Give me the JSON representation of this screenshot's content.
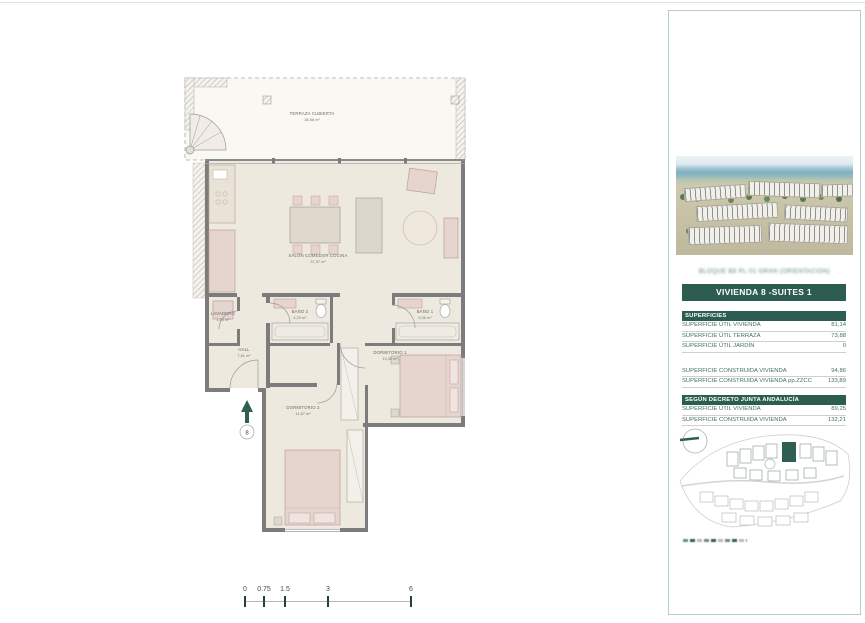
{
  "floorplan": {
    "rooms": [
      {
        "name": "TERRAZA CUBIERTA",
        "area": "38,58 m²"
      },
      {
        "name": "SALÓN COMEDOR COCINA",
        "area": "37,97 m²"
      },
      {
        "name": "LAVADERO",
        "area": "1,54 m²"
      },
      {
        "name": "HALL",
        "area": "7,81 m²"
      },
      {
        "name": "BAÑO 2",
        "area": "4,29 m²"
      },
      {
        "name": "BAÑO 1",
        "area": "5,06 m²"
      },
      {
        "name": "DORMITORIO 1",
        "area": "13,30 m²"
      },
      {
        "name": "DORMITORIO 2",
        "area": "11,87 m²"
      }
    ],
    "entrance_marker": "8",
    "scale_bar": {
      "ticks": [
        "0",
        "0.75",
        "1.5",
        "3",
        "6"
      ]
    }
  },
  "sidebar": {
    "project_line": "BLOQUE B8 PL-01 GRAN (ORIENTACIÓN)",
    "unit_title": "VIVIENDA 8 -SUITES 1",
    "surfaces": {
      "header": "SUPERFICIES",
      "rows": [
        {
          "label": "SUPERFICIE ÚTIL VIVIENDA",
          "value": "81,14"
        },
        {
          "label": "SUPERFICIE ÚTIL TERRAZA",
          "value": "73,88"
        },
        {
          "label": "SUPERFICIE ÚTIL JARDÍN",
          "value": "0"
        }
      ],
      "rows2": [
        {
          "label": "SUPERFICIE CONSTRUIDA VIVIENDA",
          "value": "94,86"
        },
        {
          "label": "SUPERFICIE CONSTRUIDA VIVIENDA pp.ZZCC",
          "value": "133,89"
        }
      ],
      "decree_header": "SEGÚN DECRETO JUNTA ANDALUCÍA",
      "rows3": [
        {
          "label": "SUPERFICIE ÚTIL VIVIENDA",
          "value": "89,25"
        },
        {
          "label": "SUPERFICIE CONSTRUIDA VIVIENDA",
          "value": "132,21"
        }
      ]
    }
  },
  "colors": {
    "accent_green": "#2d5c50",
    "table_text_green": "#3f7263",
    "wall_gray": "#7c7c7c",
    "floor_beige": "#eee9df",
    "furniture_pink": "#e6d4cf"
  }
}
